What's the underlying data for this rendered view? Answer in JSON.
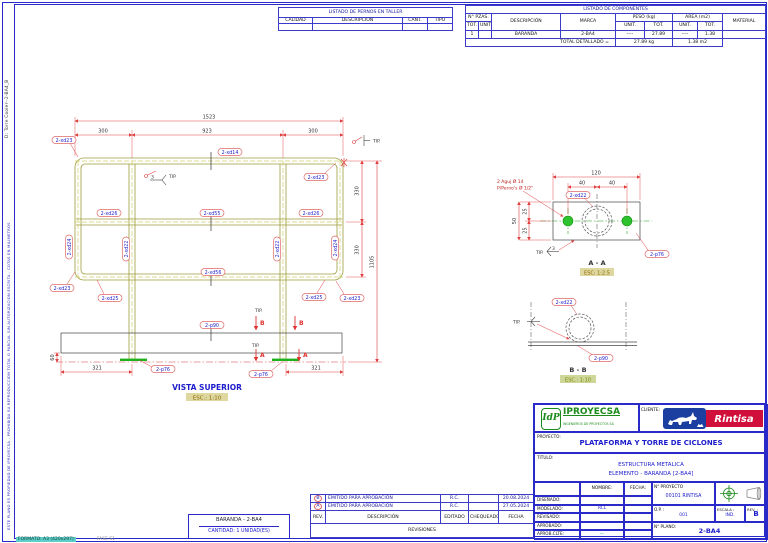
{
  "sheet": {
    "vertical_file_label": "D: Torre Cooler--2-BA4_B",
    "vertical_disclaimer": "ESTE PLANO ES PROPIEDAD DE IPROYECSA - PROHIBIDA SU REPRODUCCION TOTAL O PARCIAL SIN AUTORIZACION ESCRITA - COTAS EN MILIMETROS",
    "format_label": "FORMATO: A3 (420x297)",
    "phase_label": "FASE S1"
  },
  "bolts_table": {
    "title": "LISTADO DE PERNOS EN TALLER",
    "headers": [
      "CALIDAD",
      "DESCRIPCIÓN",
      "CANT.",
      "TIPO"
    ]
  },
  "components_table": {
    "title": "LISTADO DE COMPONENTES",
    "col_pzas": "N° PZAS.",
    "col_tot": "TOT.",
    "col_unit": "UNIT.",
    "col_desc": "DESCRIPCIÓN",
    "col_marca": "MARCA",
    "col_peso": "PESO (kg)",
    "col_area": "AREA (m2)",
    "col_material": "MATERIAL",
    "assembly": {
      "tot": "1",
      "desc": "BARANDA",
      "marca": "2-BA4",
      "pu": "----",
      "pt": "27.89",
      "au": "----",
      "at": "1.38"
    },
    "rows": [
      {
        "unit": "2",
        "name": "PL6.0*50",
        "x": "x",
        "len": "120",
        "marca": "2-p76",
        "pu": "0.28",
        "pt": "0.57",
        "au": "0.01",
        "at": "0.03",
        "mat": "A36"
      },
      {
        "unit": "1",
        "name": "PLT_3/16X4",
        "x": "x",
        "len": "1566",
        "marca": "2-p90",
        "pu": "5.94",
        "pt": "5.94",
        "au": "0.33",
        "at": "0.33",
        "mat": "A36"
      },
      {
        "unit": "1",
        "name": "PIPE1-1/2STD",
        "x": "x",
        "len": "1427",
        "marca": "2-xd14",
        "pu": "3.88",
        "pt": "3.88",
        "au": "0.19",
        "at": "0.19",
        "mat": "A53"
      },
      {
        "unit": "2",
        "name": "PIPE1-1/2STD",
        "x": "x",
        "len": "1099",
        "marca": "2-xd22",
        "pu": "2.99",
        "pt": "5.97",
        "au": "0.15",
        "at": "0.29",
        "mat": "A53"
      },
      {
        "unit": "4",
        "name": "CODO 90° Ø1-1/2STD",
        "x": "",
        "len": "75",
        "marca": "2-xd23",
        "pu": "0.24",
        "pt": "0.96",
        "au": "0.01",
        "at": "0.04",
        "mat": "A53"
      },
      {
        "unit": "2",
        "name": "PIPE1-1/2STD",
        "x": "x",
        "len": "564",
        "marca": "2-xd24",
        "pu": "1.53",
        "pt": "3.07",
        "au": "0.08",
        "at": "0.15",
        "mat": "A53"
      },
      {
        "unit": "2",
        "name": "PIPE1-1/2STD",
        "x": "x",
        "len": "252",
        "marca": "2-xd25",
        "pu": "0.68",
        "pt": "1.37",
        "au": "0.03",
        "at": "0.07",
        "mat": "A53"
      },
      {
        "unit": "2",
        "name": "PIPE1-1/4STD",
        "x": "x",
        "len": "300",
        "marca": "2-xd26",
        "pu": "0.71",
        "pt": "1.43",
        "au": "0.03",
        "at": "0.06",
        "mat": "A53"
      },
      {
        "unit": "1",
        "name": "PIPE1-1/4STD",
        "x": "x",
        "len": "923",
        "marca": "2-xd55",
        "pu": "2.20",
        "pt": "2.20",
        "au": "0.10",
        "at": "0.10",
        "mat": "A53"
      },
      {
        "unit": "1",
        "name": "PIPE1-1/2STD",
        "x": "x",
        "len": "923",
        "marca": "2-xd56",
        "pu": "2.51",
        "pt": "2.51",
        "au": "0.12",
        "at": "0.12",
        "mat": "A53"
      }
    ],
    "total_label": "TOTAL DETALLADO =",
    "total_weight": "27.89  kg",
    "total_area": "1.38  m2"
  },
  "plan": {
    "title": "VISTA SUPERIOR",
    "scale": "ESC.: 1:10",
    "dim_total_w": "1523",
    "dim_seg_l": "300",
    "dim_seg_m": "923",
    "dim_seg_r": "300",
    "dim_h1": "330",
    "dim_h2": "330",
    "dim_total_h": "1105",
    "dim_plate": "60",
    "dim_base_l": "321",
    "dim_base_r": "321",
    "tip": "TIP.",
    "weld": "3",
    "section_a": "A",
    "section_b": "B",
    "labels": {
      "xd14": "2-xd14",
      "xd22": "2-xd22",
      "xd23": "2-xd23",
      "xd24": "2-xd24",
      "xd25": "2-xd25",
      "xd26": "2-xd26",
      "xd55": "2-xd55",
      "xd56": "2-xd56",
      "p76": "2-p76",
      "p90": "2-p90"
    }
  },
  "detail_a": {
    "title": "A - A",
    "scale": "ESC: 1:2.5",
    "note1": "2 Aguj Ø 14",
    "note2": "P/Perno's Ø 1/2\"",
    "dim_w": "120",
    "dim_40a": "40",
    "dim_40b": "40",
    "dim_h": "50",
    "dim_25a": "25",
    "dim_25b": "25",
    "label_pipe": "2-xd22",
    "label_plate": "2-p76",
    "tip": "TIP.",
    "weld": "3"
  },
  "detail_b": {
    "title": "B - B",
    "scale": "ESC.: 1:10",
    "label_pipe": "2-xd22",
    "label_plate": "2-p90",
    "tip": "TIP."
  },
  "title_block": {
    "logo_mark": "IdP",
    "logo_name": "IPROYECSA",
    "logo_sub": "INGENIEROS DE PROYECTOS SA",
    "cliente_label": "CLIENTE:",
    "cliente_name": "Rintisa",
    "proyecto_label": "PROYECTO:",
    "proyecto_value": "PLATAFORMA Y TORRE DE CICLONES",
    "titulo_label": "TITULO:",
    "titulo_line1": "ESTRUCTURA METALICA",
    "titulo_line2": "ELEMENTO - BARANDA [2-BA4]",
    "nombre_label": "NOMBRE:",
    "fecha_label": "FECHA:",
    "row_labels": [
      "DISEÑADO:",
      "MODELADO:",
      "REVISADO:",
      "APROBADO:",
      "APROB.CLTE:"
    ],
    "modelado_value": "RCL",
    "aprob_clte_value": "—",
    "nproyecto_label": "N° PROYECTO",
    "nproyecto_value": "00101 RINTISA",
    "op_label": "O.P. :",
    "op_value": "001",
    "escala_label": "ESCALA :",
    "escala_value": "IND.",
    "rev_label": "REV. :",
    "rev_value": "B",
    "nplano_label": "N° PLANO:",
    "nplano_value": "2-BA4"
  },
  "revisions": {
    "headers": [
      "REV.",
      "DESCRIPCIÓN",
      "EDITADO",
      "CHEQUEADO",
      "FECHA"
    ],
    "rows": [
      {
        "rev": "B",
        "desc": "EMITIDO PARA APROBACIÓN",
        "editado": "R.C.",
        "chequeado": "",
        "fecha": "20.08.2024"
      },
      {
        "rev": "A",
        "desc": "EMITIDO PARA APROBACIÓN",
        "editado": "R.C.",
        "chequeado": "",
        "fecha": "27.05.2024"
      }
    ],
    "footer": "REVISIONES"
  },
  "part_box": {
    "line1": "BARANDA - 2-BA4",
    "line2": "CANTIDAD: 1 UNIDAD(ES)"
  }
}
